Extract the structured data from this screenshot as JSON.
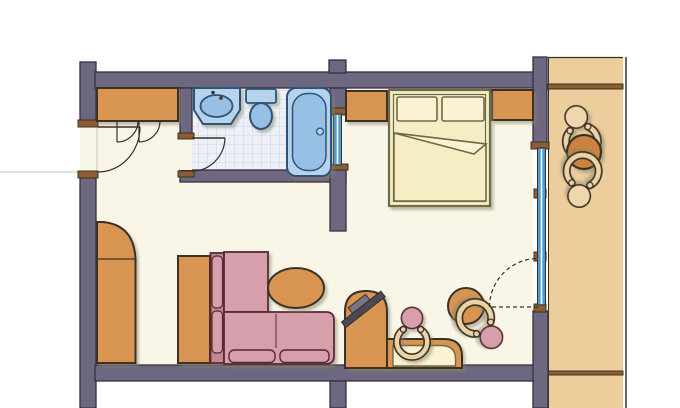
{
  "diagram_type": "hand-drawn hotel room floor plan, top view, no text labels",
  "palette": {
    "paper": "#ffffff",
    "floor": "#f9f5e7",
    "wall": "#6e6780",
    "wallOutline": "#343040",
    "ink": "#3a3128",
    "sillBrown": "#8e5c2f",
    "orange": "#d79551",
    "orangeDeep": "#cd8340",
    "tan": "#eccd9c",
    "tanLight": "#f0d7ab",
    "chairBand": "#ecd2a4",
    "pink": "#d69fab",
    "pinkDeep": "#c58694",
    "pinkOutline": "#572b33",
    "cream": "#f6edc5",
    "creamLight": "#faf3d3",
    "creamOutline": "#6e6a45",
    "blueLight": "#b7d3ec",
    "blueMid": "#97c0e4",
    "blueOutline": "#2a5579",
    "tileBg": "#edf1f7",
    "tileLine": "#c9d6e6",
    "glass": "#4d9ecf",
    "tvDark": "#4d4756",
    "tvLight": "#7a7386",
    "shadow": "#8a8468"
  },
  "elements": {
    "rooms": [
      "entry-hall",
      "bathroom",
      "bedroom-living-area",
      "balcony"
    ],
    "bathroom_fixtures": [
      "washbasin-counter",
      "toilet",
      "bathtub"
    ],
    "furniture": [
      "entry-wardrobe",
      "double-bed-with-two-pillows",
      "nightstand-left",
      "nightstand-right",
      "tall-corner-cabinet",
      "sideboard-strip",
      "l-shaped-sofa",
      "oval-coffee-table",
      "tv-cabinet-with-tv",
      "desk-with-inset-top",
      "desk-chair",
      "round-side-table",
      "lounge-chair",
      "balcony-chair-upper",
      "balcony-chair-lower",
      "balcony-round-table"
    ],
    "openings": [
      "entry-door-with-swing-arc",
      "closet-double-doors-with-arcs",
      "bathroom-door-with-swing-arc",
      "interior-window-bathroom-to-bedroom",
      "full-height-window-wall-right",
      "balcony-door-dashed-swing",
      "balcony-railing-line",
      "balcony-divider-strips"
    ]
  }
}
